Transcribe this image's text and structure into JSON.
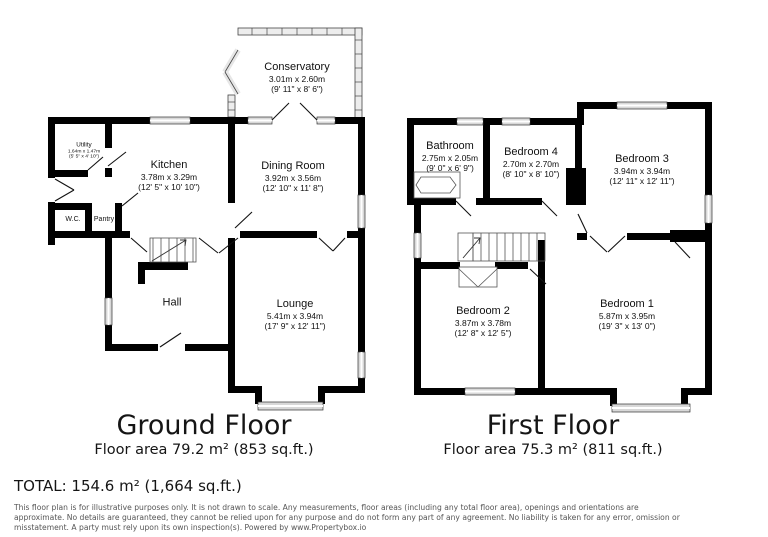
{
  "ground_floor": {
    "title": "Ground Floor",
    "area": "Floor area 79.2 m² (853 sq.ft.)",
    "rooms": {
      "conservatory": {
        "name": "Conservatory",
        "metric": "3.01m x 2.60m",
        "imperial": "(9' 11\" x 8' 6\")"
      },
      "utility": {
        "name": "Utility",
        "metric": "1.64m x 1.47m",
        "imperial": "(5' 5\" x 4' 10\")"
      },
      "kitchen": {
        "name": "Kitchen",
        "metric": "3.78m x 3.29m",
        "imperial": "(12' 5\" x 10' 10\")"
      },
      "dining_room": {
        "name": "Dining Room",
        "metric": "3.92m x 3.56m",
        "imperial": "(12' 10\" x 11' 8\")"
      },
      "wc": {
        "name": "W.C."
      },
      "pantry": {
        "name": "Pantry"
      },
      "hall": {
        "name": "Hall"
      },
      "lounge": {
        "name": "Lounge",
        "metric": "5.41m x 3.94m",
        "imperial": "(17' 9\" x 12' 11\")"
      }
    }
  },
  "first_floor": {
    "title": "First Floor",
    "area": "Floor area 75.3 m² (811 sq.ft.)",
    "rooms": {
      "bathroom": {
        "name": "Bathroom",
        "metric": "2.75m x 2.05m",
        "imperial": "(9' 0\" x 6' 9\")"
      },
      "bedroom4": {
        "name": "Bedroom 4",
        "metric": "2.70m x 2.70m",
        "imperial": "(8' 10\" x 8' 10\")"
      },
      "bedroom3": {
        "name": "Bedroom 3",
        "metric": "3.94m x 3.94m",
        "imperial": "(12' 11\" x 12' 11\")"
      },
      "bedroom2": {
        "name": "Bedroom 2",
        "metric": "3.87m x 3.78m",
        "imperial": "(12' 8\" x 12' 5\")"
      },
      "bedroom1": {
        "name": "Bedroom 1",
        "metric": "5.87m x 3.95m",
        "imperial": "(19' 3\" x 13' 0\")"
      }
    }
  },
  "total": "TOTAL: 154.6 m² (1,664 sq.ft.)",
  "disclaimer_lines": [
    "This floor plan is for illustrative purposes only. It is not drawn to scale. Any measurements, floor areas (including any total floor area), openings and orientations are",
    "approximate. No details are guaranteed, they cannot be relied upon for any purpose and do not form any part of any agreement. No liability is taken for any error, omission or",
    "misstatement. A party must rely upon its own inspection(s). Powered by www.Propertybox.io"
  ],
  "colors": {
    "wall": "#000000",
    "window_fill": "#d8d8d8",
    "text": "#151515",
    "disclaimer_text": "#555555",
    "background": "#ffffff"
  }
}
